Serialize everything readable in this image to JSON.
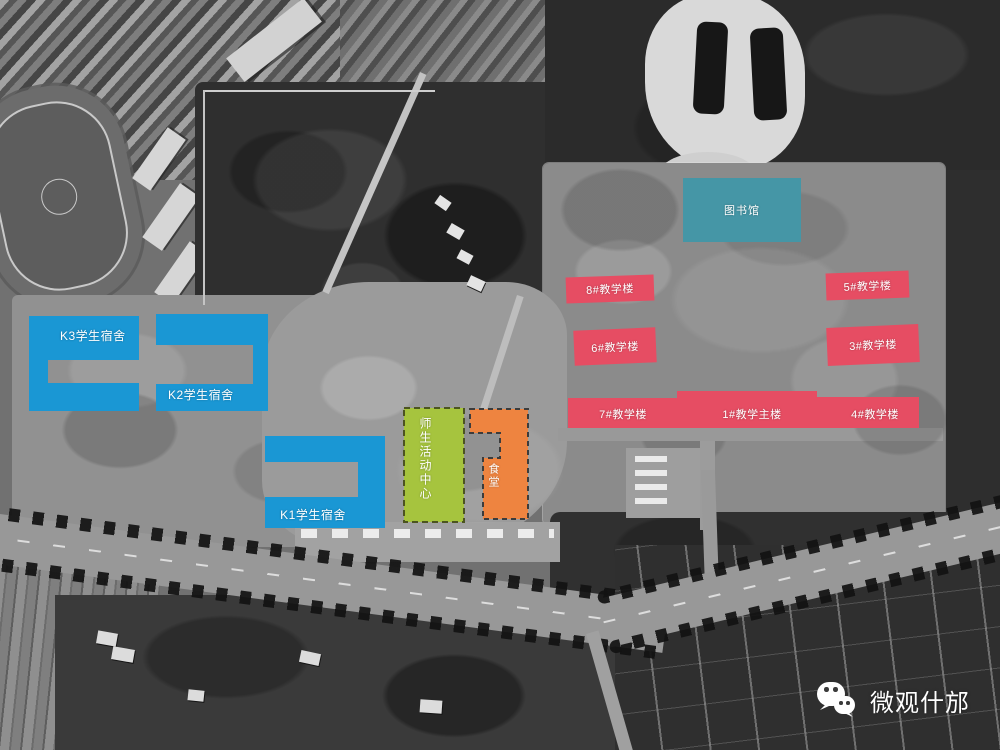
{
  "colors": {
    "dorm_blue": "#1a97d4",
    "activity_green": "#a6c43e",
    "canteen_orange": "#ee8440",
    "library_teal": "#4596a6",
    "teaching_red": "#e64d63",
    "label_text": "#ffffff"
  },
  "map_labels": {
    "dorms": [
      {
        "id": "k3",
        "label": "K3学生宿舍"
      },
      {
        "id": "k2",
        "label": "K2学生宿舍"
      },
      {
        "id": "k1",
        "label": "K1学生宿舍"
      }
    ],
    "activity_center": {
      "label": "师生活动中心"
    },
    "canteen": {
      "label": "食堂"
    },
    "library": {
      "label": "图书馆"
    },
    "teaching": [
      {
        "id": "b8",
        "label": "8#教学楼"
      },
      {
        "id": "b5",
        "label": "5#教学楼"
      },
      {
        "id": "b6",
        "label": "6#教学楼"
      },
      {
        "id": "b3",
        "label": "3#教学楼"
      },
      {
        "id": "b7",
        "label": "7#教学楼"
      },
      {
        "id": "b1",
        "label": "1#教学主楼"
      },
      {
        "id": "b4",
        "label": "4#教学楼"
      }
    ]
  },
  "watermark": {
    "icon": "wechat-icon",
    "text": "微观什邡"
  }
}
